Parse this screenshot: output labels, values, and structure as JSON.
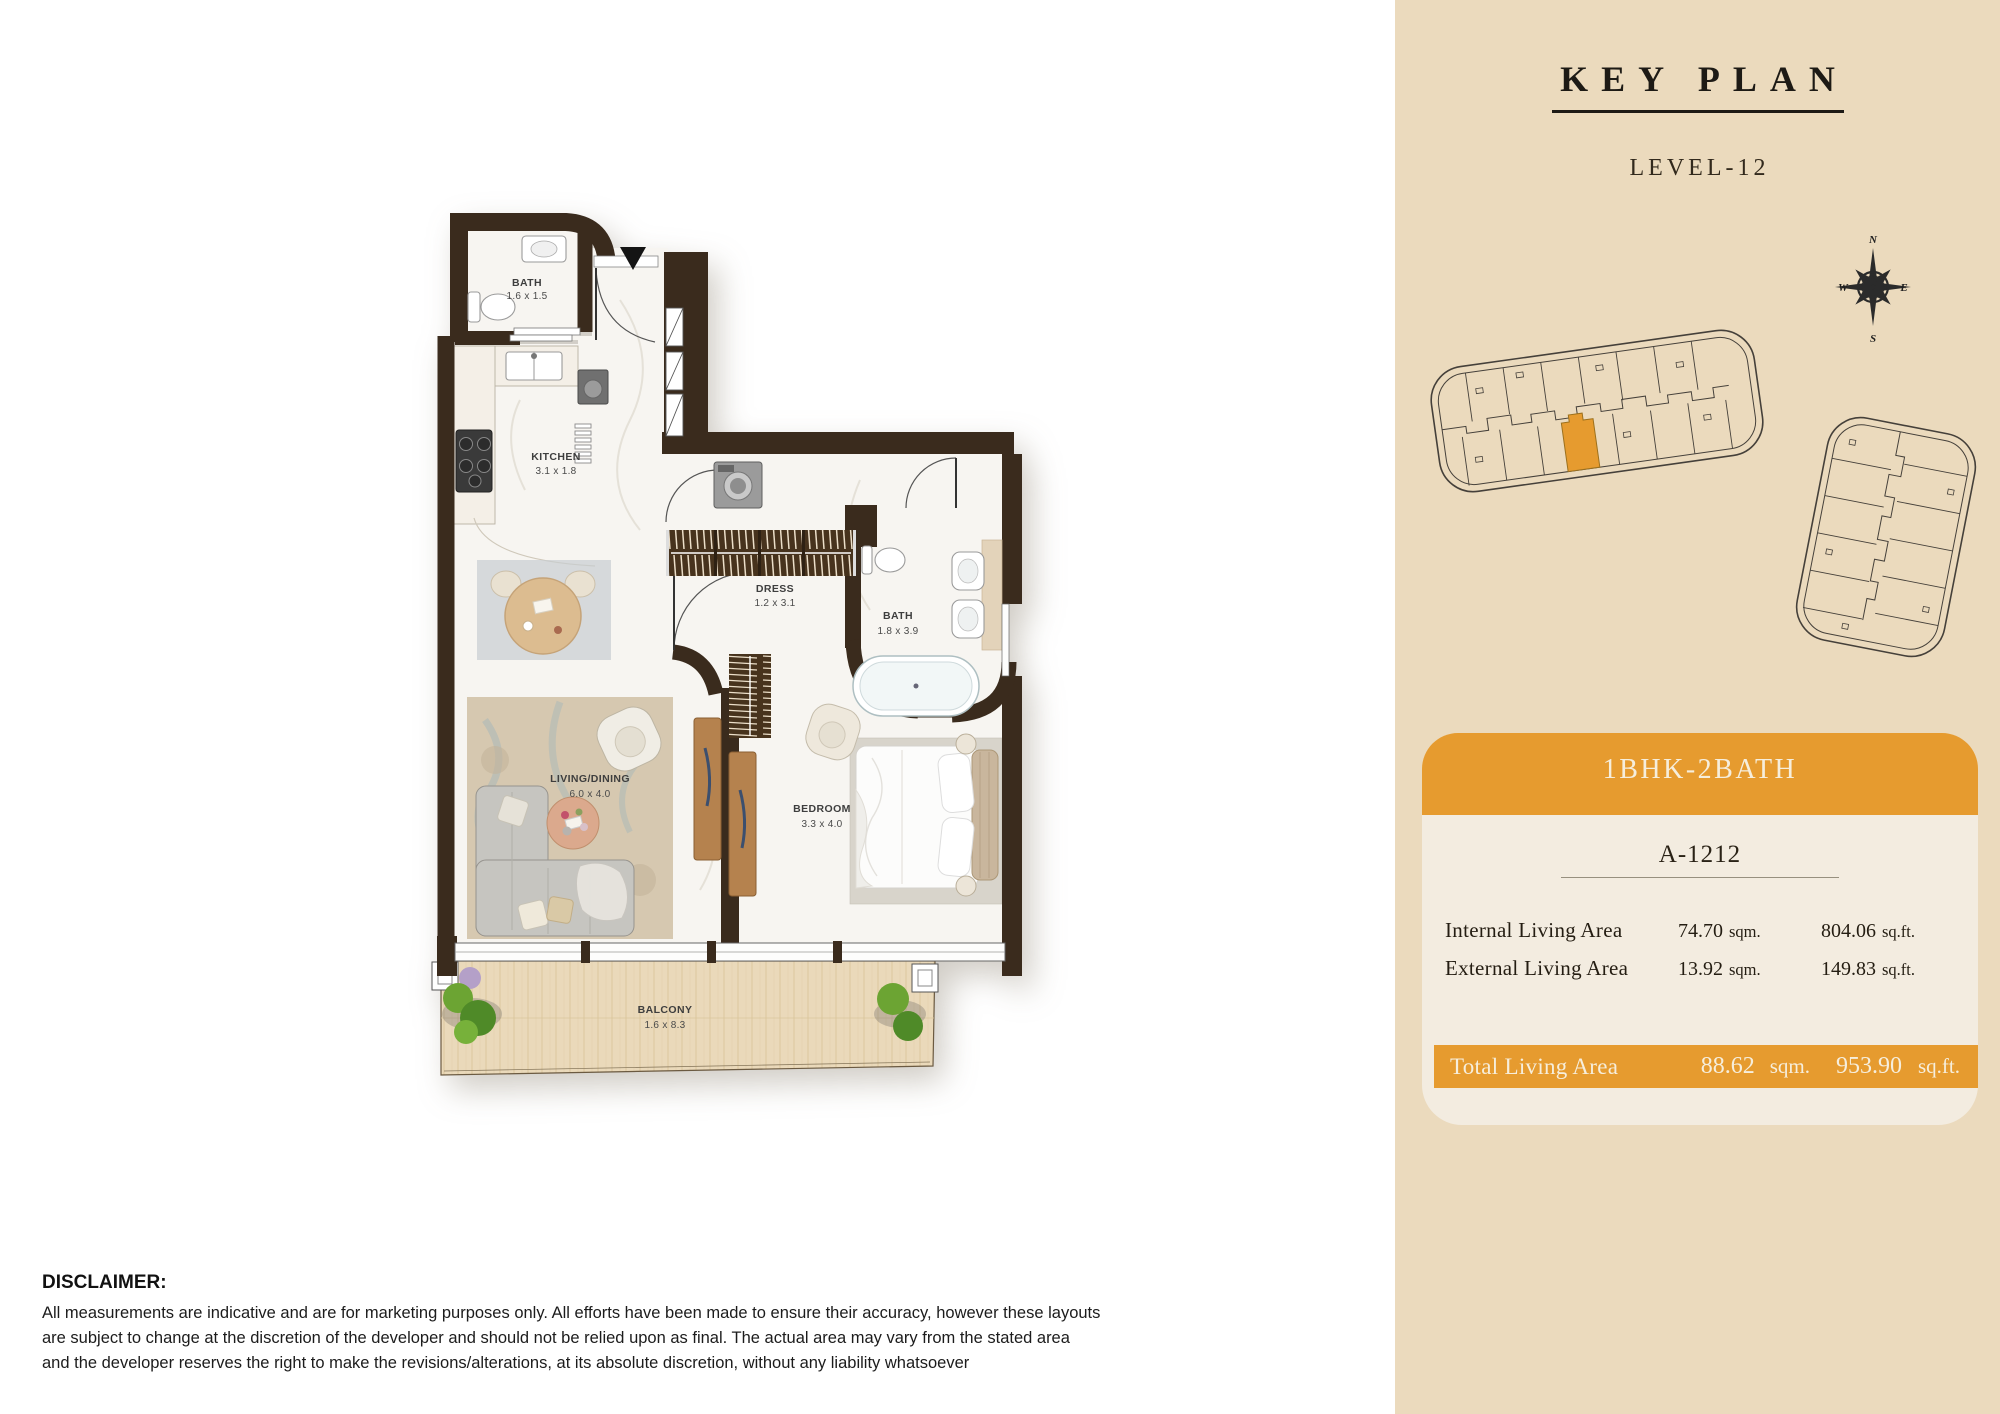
{
  "key_plan": {
    "title": "KEY PLAN",
    "level": "LEVEL-12"
  },
  "compass": {
    "n": "N",
    "e": "E",
    "s": "S",
    "w": "W"
  },
  "unit_card": {
    "type": "1BHK-2BATH",
    "unit_no": "A-1212",
    "rows": [
      {
        "label": "Internal Living Area",
        "sqm": "74.70",
        "sqm_unit": "sqm.",
        "sqft": "804.06",
        "sqft_unit": "sq.ft."
      },
      {
        "label": "External Living Area",
        "sqm": "13.92",
        "sqm_unit": "sqm.",
        "sqft": "149.83",
        "sqft_unit": "sq.ft."
      }
    ],
    "total": {
      "label": "Total Living Area",
      "sqm": "88.62",
      "sqm_unit": "sqm.",
      "sqft": "953.90",
      "sqft_unit": "sq.ft."
    }
  },
  "plan": {
    "rooms": [
      {
        "name": "BATH",
        "dims": "1.6 x 1.5"
      },
      {
        "name": "KITCHEN",
        "dims": "3.1 x 1.8"
      },
      {
        "name": "DRESS",
        "dims": "1.2 x 3.1"
      },
      {
        "name": "BATH",
        "dims": "1.8 x 3.9"
      },
      {
        "name": "LIVING/DINING",
        "dims": "6.0 x 4.0"
      },
      {
        "name": "BEDROOM",
        "dims": "3.3 x 4.0"
      },
      {
        "name": "BALCONY",
        "dims": "1.6 x 8.3"
      }
    ]
  },
  "disclaimer": {
    "heading": "DISCLAIMER:",
    "lines": [
      "All measurements are indicative and are for marketing purposes only. All efforts have been made to ensure their accuracy, however these layouts",
      "are subject to change at the discretion of the developer and should not be relied upon as final. The actual area may vary from the stated area",
      "and the developer reserves the right to make the revisions/alterations, at its absolute discretion, without any liability whatsoever"
    ]
  },
  "colors": {
    "accent": "#E69B2F",
    "panel": "#EBDABD",
    "card": "#F3ECE0",
    "wall": "#3A2B1D",
    "cream": "#F6EEDC"
  }
}
